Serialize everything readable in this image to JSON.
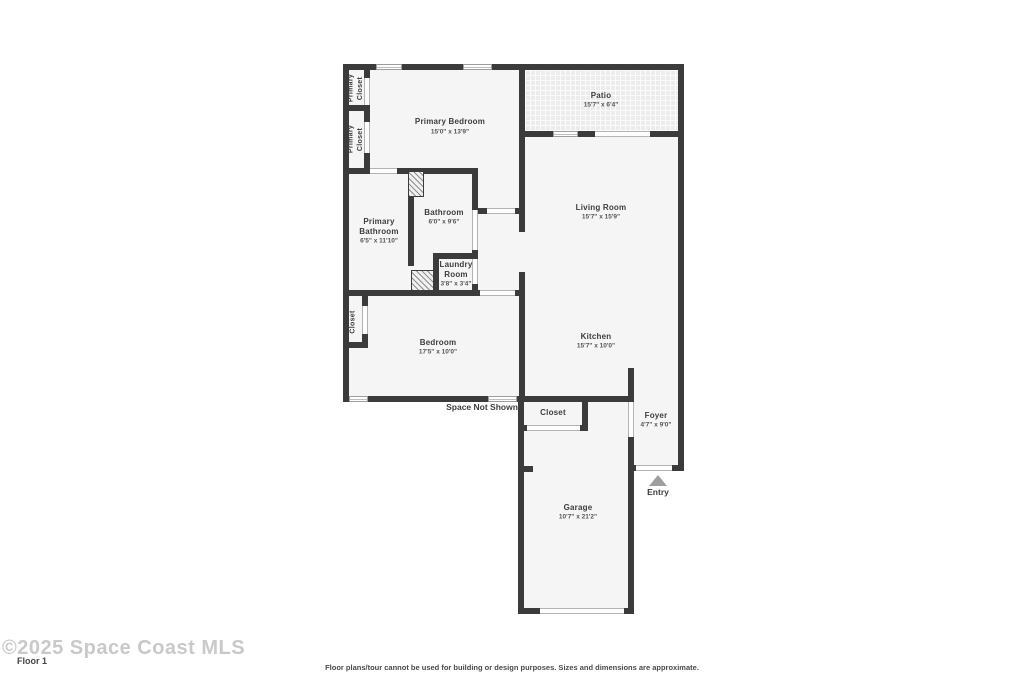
{
  "rooms": {
    "primary_closet_1": {
      "name": "Primary\nCloset"
    },
    "primary_closet_2": {
      "name": "Primary\nCloset"
    },
    "primary_bedroom": {
      "name": "Primary Bedroom",
      "dims": "15'0\" x 13'9\""
    },
    "patio": {
      "name": "Patio",
      "dims": "15'7\" x 6'4\""
    },
    "living_room": {
      "name": "Living Room",
      "dims": "15'7\" x 15'9\""
    },
    "primary_bathroom": {
      "name": "Primary\nBathroom",
      "dims": "6'5\" x 11'10\""
    },
    "bathroom": {
      "name": "Bathroom",
      "dims": "6'0\" x 9'6\""
    },
    "laundry_room": {
      "name": "Laundry\nRoom",
      "dims": "3'8\" x 3'4\""
    },
    "bedroom_closet": {
      "name": "Closet"
    },
    "bedroom": {
      "name": "Bedroom",
      "dims": "17'5\" x 10'0\""
    },
    "kitchen": {
      "name": "Kitchen",
      "dims": "15'7\" x 10'0\""
    },
    "entry_closet": {
      "name": "Closet"
    },
    "foyer": {
      "name": "Foyer",
      "dims": "4'7\" x 9'0\""
    },
    "garage": {
      "name": "Garage",
      "dims": "10'7\" x 21'2\""
    }
  },
  "annotations": {
    "space_not_shown": "Space Not Shown",
    "entry": "Entry"
  },
  "footer": {
    "watermark": "©2025 Space Coast MLS",
    "floor_label": "Floor 1",
    "disclaimer": "Floor plans/tour cannot be used for building or design purposes. Sizes and dimensions are approximate."
  },
  "colors": {
    "wall": "#3b3b3b",
    "floor": "#f5f5f5",
    "exterior": "#ffffff",
    "entry_marker": "#9e9e9e",
    "label_text": "#3d3d3d"
  }
}
